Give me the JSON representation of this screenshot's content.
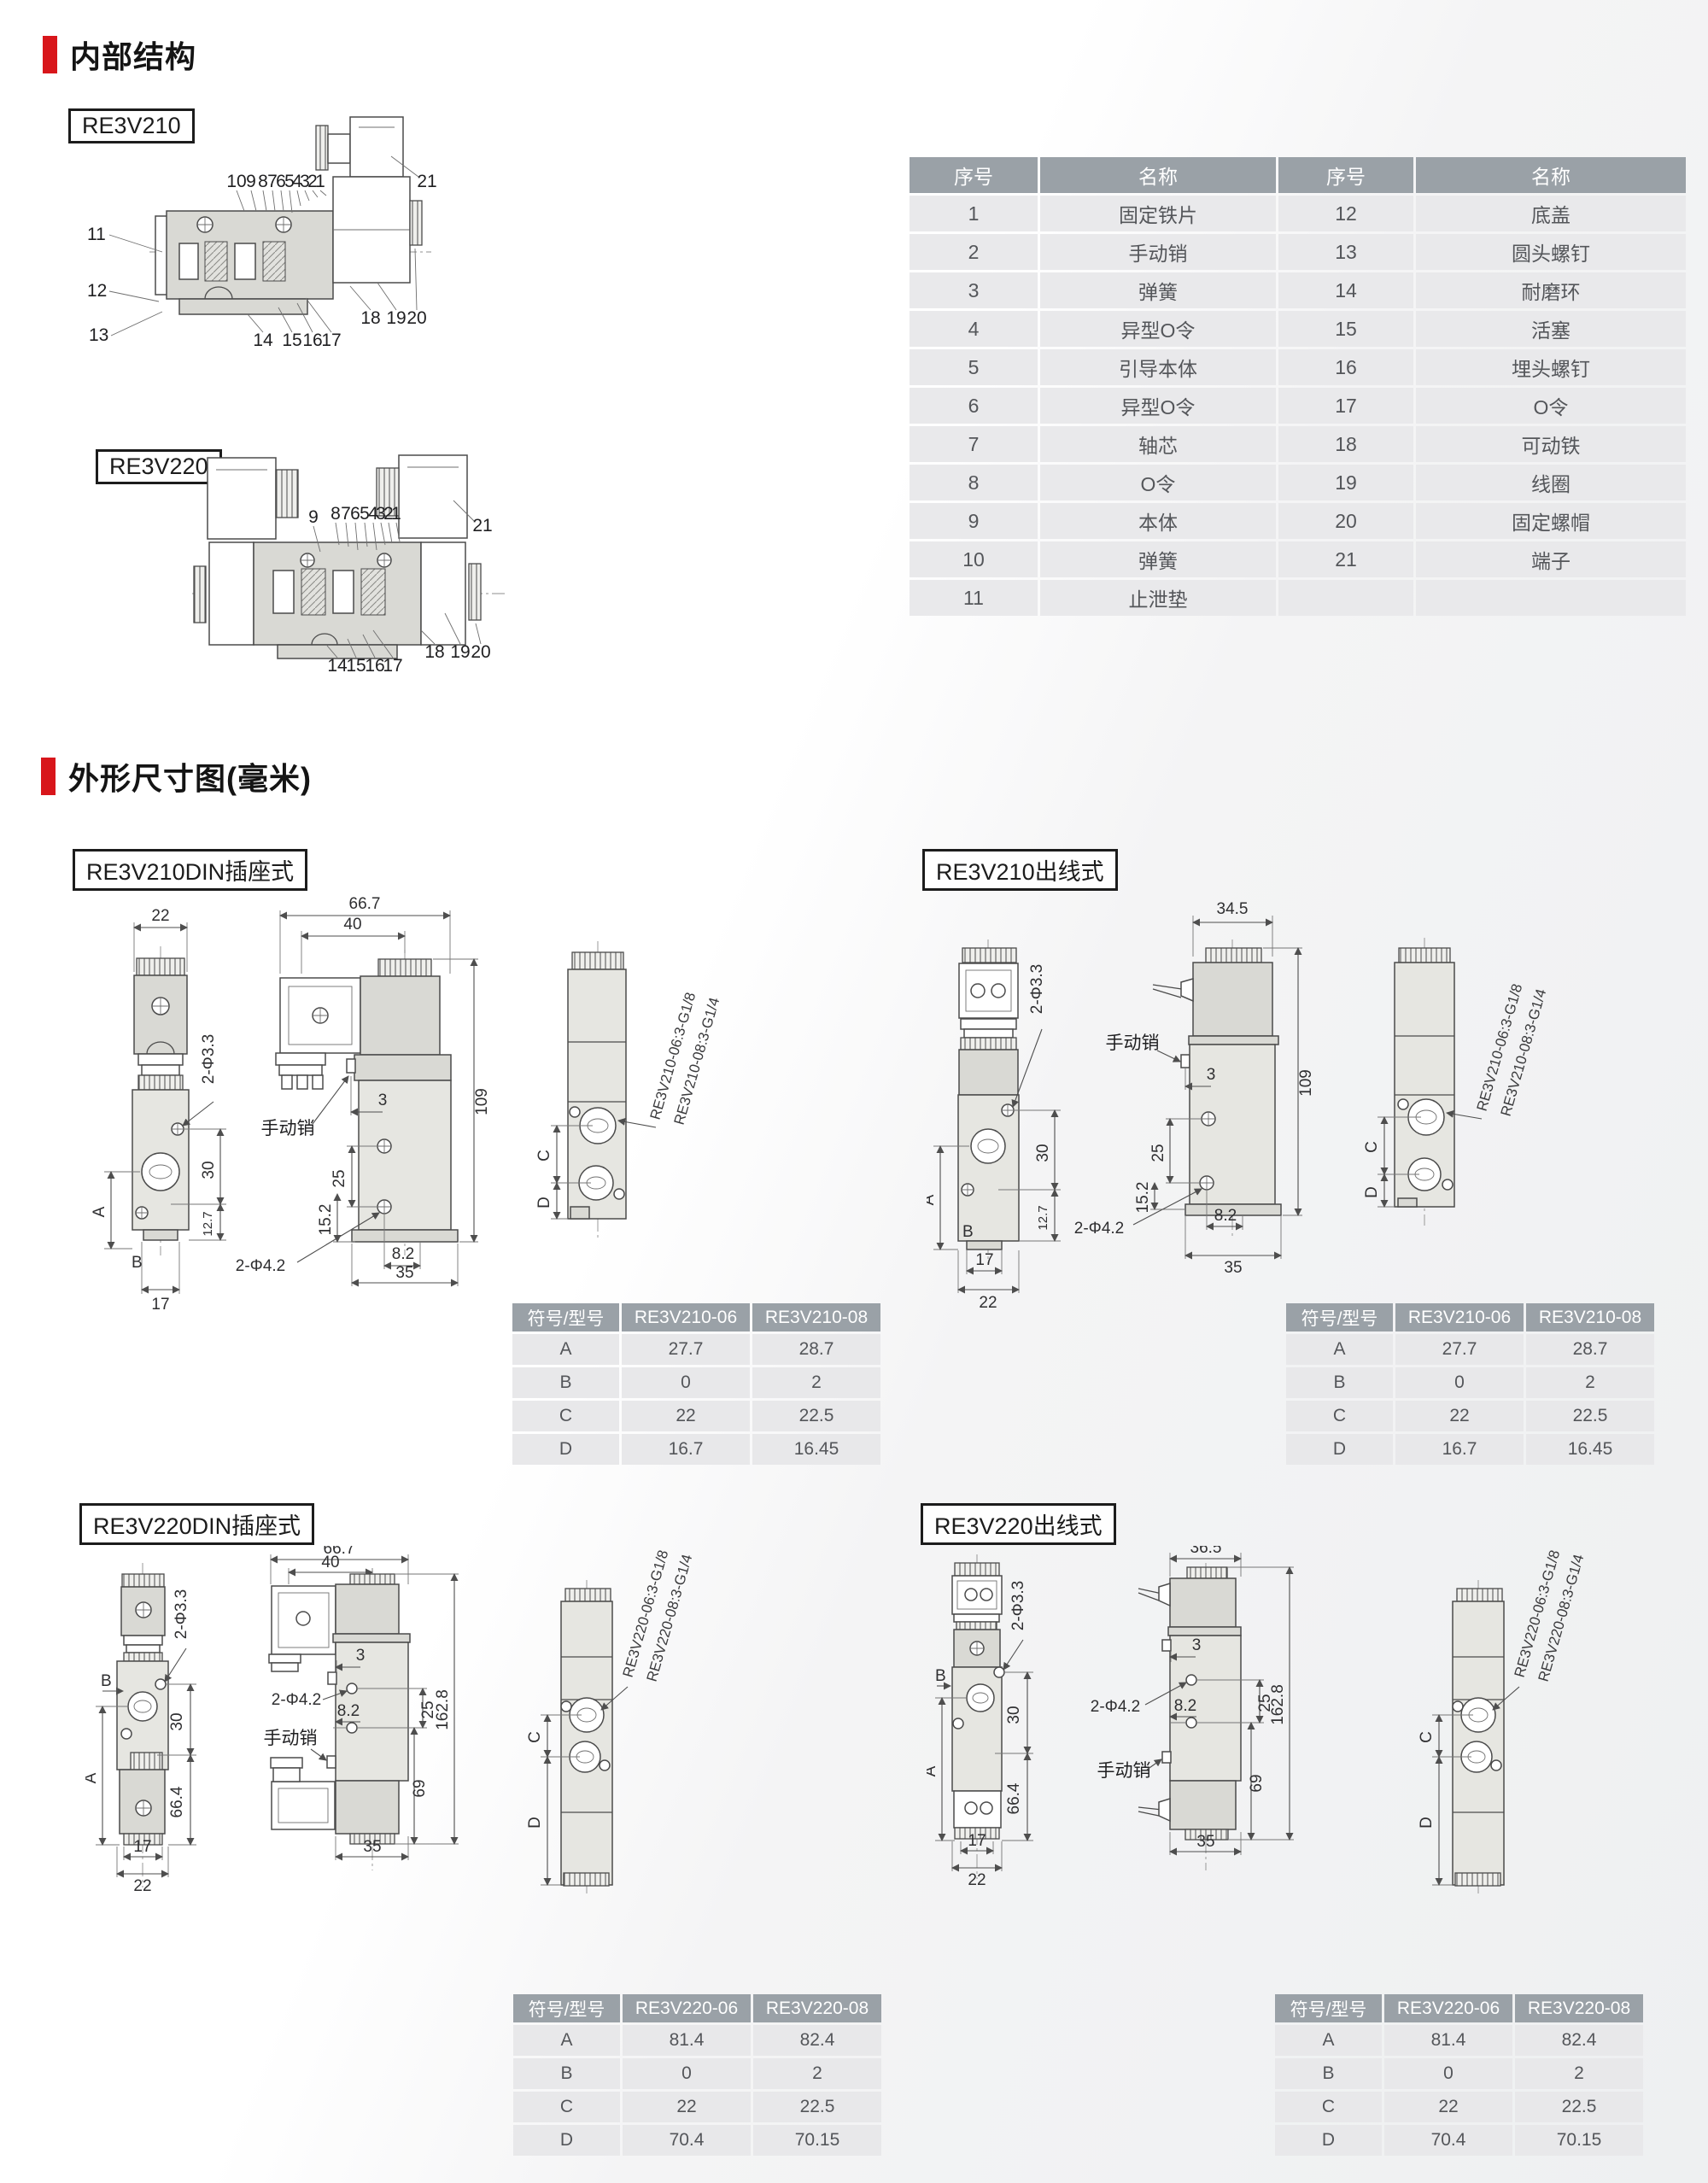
{
  "page": {
    "section1_title": "内部结构",
    "section2_title": "外形尺寸图(毫米)",
    "accent_red": "#d8161b"
  },
  "internal": {
    "re3v210": {
      "label": "RE3V210",
      "top": [
        "10",
        "9",
        "8",
        "7",
        "6",
        "5",
        "4",
        "3",
        "2",
        "1"
      ],
      "left": [
        "11",
        "12",
        "13"
      ],
      "bottom": [
        "14",
        "15",
        "16",
        "17"
      ],
      "bottom_right": [
        "18",
        "19",
        "20"
      ],
      "right": "21"
    },
    "re3v220": {
      "label": "RE3V220",
      "top": [
        "9",
        "8",
        "7",
        "6",
        "5",
        "4",
        "3",
        "2",
        "1"
      ],
      "bottom": [
        "14",
        "15",
        "16",
        "17"
      ],
      "bottom_right": [
        "18",
        "19",
        "20"
      ],
      "right": "21"
    },
    "parts_table": {
      "headers": [
        "序号",
        "名称",
        "序号",
        "名称"
      ],
      "rows": [
        [
          "1",
          "固定铁片",
          "12",
          "底盖"
        ],
        [
          "2",
          "手动销",
          "13",
          "圆头螺钉"
        ],
        [
          "3",
          "弹簧",
          "14",
          "耐磨环"
        ],
        [
          "4",
          "异型O令",
          "15",
          "活塞"
        ],
        [
          "5",
          "引导本体",
          "16",
          "埋头螺钉"
        ],
        [
          "6",
          "异型O令",
          "17",
          "O令"
        ],
        [
          "7",
          "轴芯",
          "18",
          "可动铁"
        ],
        [
          "8",
          "O令",
          "19",
          "线圈"
        ],
        [
          "9",
          "本体",
          "20",
          "固定螺帽"
        ],
        [
          "10",
          "弹簧",
          "21",
          "端子"
        ],
        [
          "11",
          "止泄垫",
          "",
          ""
        ]
      ]
    }
  },
  "blocks": [
    {
      "label": "RE3V210DIN插座式",
      "front": {
        "w22": "22",
        "hole": "2-Φ3.3",
        "h30": "30",
        "h127": "12.7",
        "a": "A",
        "b": "B",
        "w17": "17"
      },
      "side": {
        "w1": "66.7",
        "w2": "40",
        "pin": "手动销",
        "n3": "3",
        "h25": "25",
        "h152": "15.2",
        "hole": "2-Φ4.2",
        "w82": "8.2",
        "w35": "35",
        "h109": "109"
      },
      "back": {
        "c": "C",
        "d": "D",
        "t1": "RE3V210-06:3-G1/8",
        "t2": "RE3V210-08:3-G1/4"
      },
      "table": {
        "headers": [
          "符号/型号",
          "RE3V210-06",
          "RE3V210-08"
        ],
        "rows": [
          [
            "A",
            "27.7",
            "28.7"
          ],
          [
            "B",
            "0",
            "2"
          ],
          [
            "C",
            "22",
            "22.5"
          ],
          [
            "D",
            "16.7",
            "16.45"
          ]
        ]
      }
    },
    {
      "label": "RE3V210出线式",
      "front": {
        "hole": "2-Φ3.3",
        "h30": "30",
        "h127": "12.7",
        "a": "A",
        "b": "B",
        "w17": "17",
        "w22": "22"
      },
      "side": {
        "w1": "34.5",
        "pin": "手动销",
        "n3": "3",
        "h25": "25",
        "h152": "15.2",
        "hole": "2-Φ4.2",
        "w82": "8.2",
        "w35": "35",
        "h109": "109"
      },
      "back": {
        "c": "C",
        "d": "D",
        "t1": "RE3V210-06:3-G1/8",
        "t2": "RE3V210-08:3-G1/4"
      },
      "table": {
        "headers": [
          "符号/型号",
          "RE3V210-06",
          "RE3V210-08"
        ],
        "rows": [
          [
            "A",
            "27.7",
            "28.7"
          ],
          [
            "B",
            "0",
            "2"
          ],
          [
            "C",
            "22",
            "22.5"
          ],
          [
            "D",
            "16.7",
            "16.45"
          ]
        ]
      }
    },
    {
      "label": "RE3V220DIN插座式",
      "front": {
        "hole": "2-Φ3.3",
        "b": "B",
        "h30": "30",
        "a": "A",
        "h664": "66.4",
        "w17": "17",
        "w22": "22"
      },
      "side": {
        "w1": "66.7",
        "w2": "40",
        "n3": "3",
        "hole": "2-Φ4.2",
        "w82": "8.2",
        "h25": "25",
        "h1628": "162.8",
        "pin": "手动销",
        "h69": "69",
        "w35": "35"
      },
      "back": {
        "c": "C",
        "d": "D",
        "t1": "RE3V220-06:3-G1/8",
        "t2": "RE3V220-08:3-G1/4"
      },
      "table": {
        "headers": [
          "符号/型号",
          "RE3V220-06",
          "RE3V220-08"
        ],
        "rows": [
          [
            "A",
            "81.4",
            "82.4"
          ],
          [
            "B",
            "0",
            "2"
          ],
          [
            "C",
            "22",
            "22.5"
          ],
          [
            "D",
            "70.4",
            "70.15"
          ]
        ]
      }
    },
    {
      "label": "RE3V220出线式",
      "front": {
        "hole": "2-Φ3.3",
        "b": "B",
        "h30": "30",
        "a": "A",
        "h664": "66.4",
        "w17": "17",
        "w22": "22"
      },
      "side": {
        "w1": "36.5",
        "n3": "3",
        "hole": "2-Φ4.2",
        "w82": "8.2",
        "h25": "25",
        "h1628": "162.8",
        "pin": "手动销",
        "h69": "69",
        "w35": "35"
      },
      "back": {
        "c": "C",
        "d": "D",
        "t1": "RE3V220-06:3-G1/8",
        "t2": "RE3V220-08:3-G1/4"
      },
      "table": {
        "headers": [
          "符号/型号",
          "RE3V220-06",
          "RE3V220-08"
        ],
        "rows": [
          [
            "A",
            "81.4",
            "82.4"
          ],
          [
            "B",
            "0",
            "2"
          ],
          [
            "C",
            "22",
            "22.5"
          ],
          [
            "D",
            "70.4",
            "70.15"
          ]
        ]
      }
    }
  ]
}
